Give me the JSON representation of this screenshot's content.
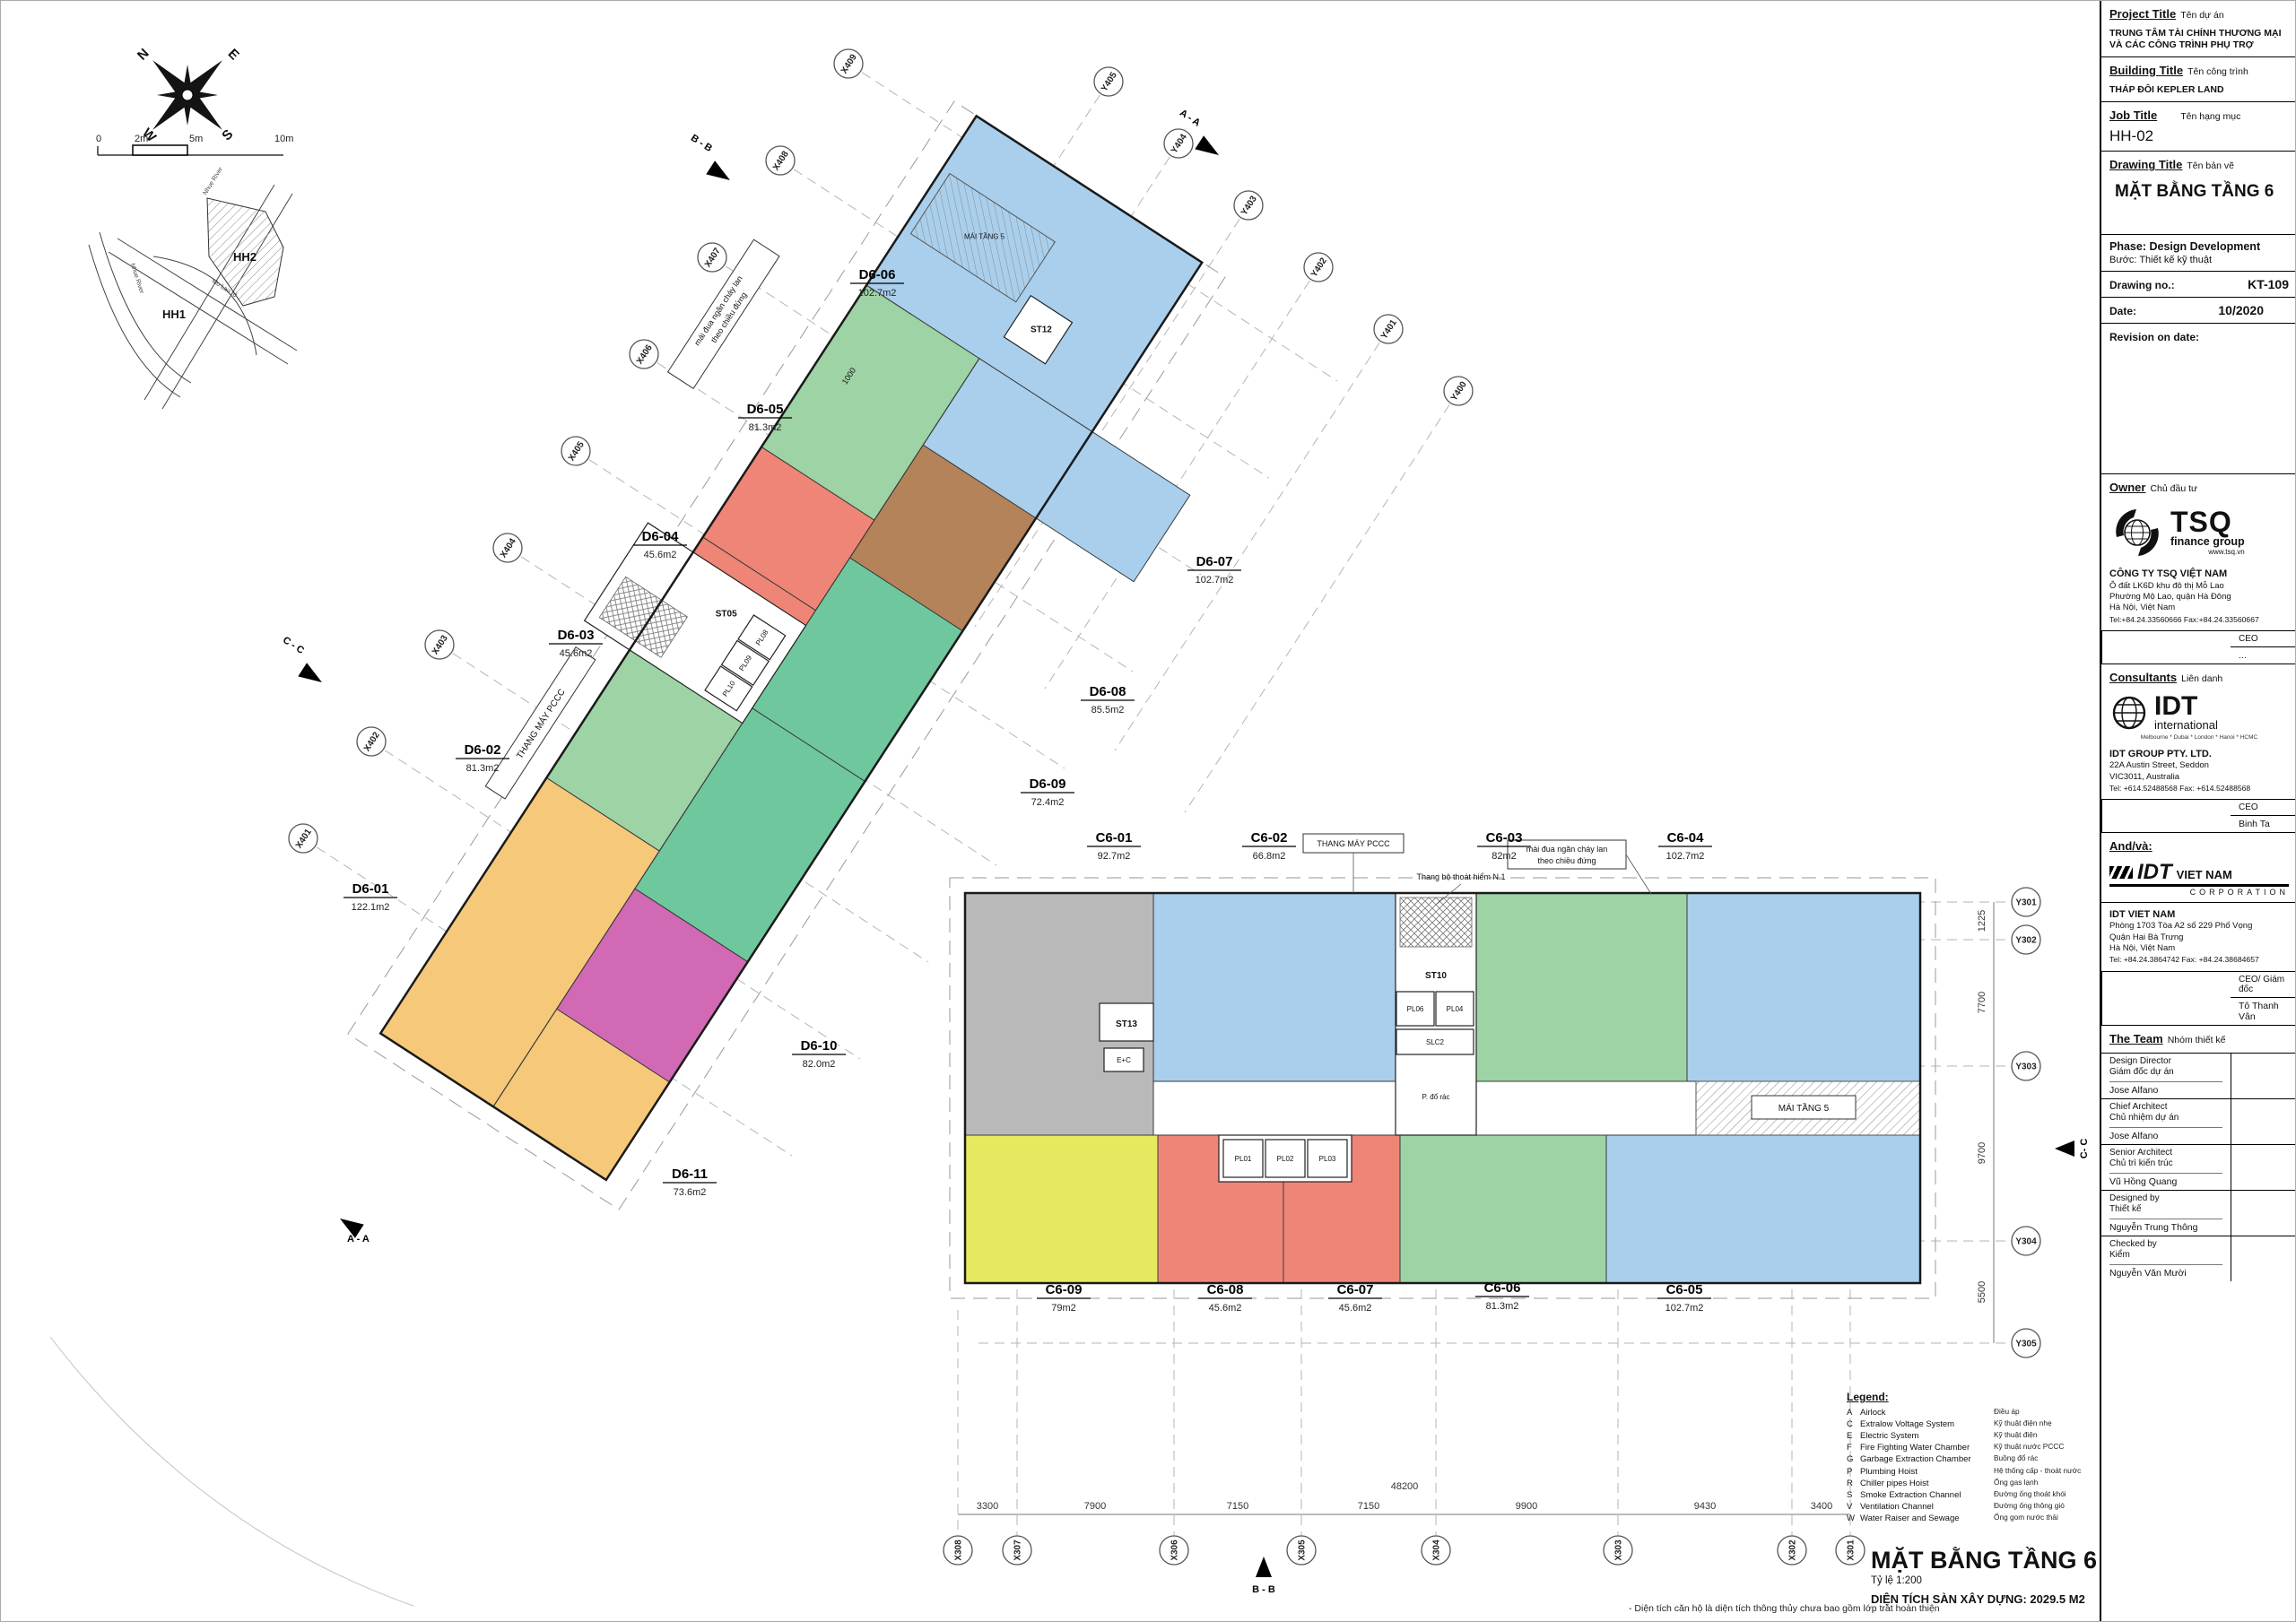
{
  "colors": {
    "blue": "#a9cfec",
    "green": "#9dd3a5",
    "teal": "#6fc79e",
    "red": "#ef8577",
    "orange": "#f6c87a",
    "brown": "#b5835a",
    "magenta": "#d169b5",
    "yellow": "#e6e95f",
    "gray": "#b9b9b9"
  },
  "compass": {
    "n": "N",
    "e": "E",
    "s": "S",
    "w": "W"
  },
  "scale_bar": {
    "t0": "0",
    "t1": "2m",
    "t2": "5m",
    "t3": "10m"
  },
  "location_map": {
    "hh1": "HH1",
    "hh2": "HH2",
    "river": "Nhue River",
    "road": "Mo Lao rd"
  },
  "units": [
    {
      "id": "D6-01",
      "area": "122.1m2",
      "color": "orange"
    },
    {
      "id": "D6-02",
      "area": "81.3m2",
      "color": "green"
    },
    {
      "id": "D6-03",
      "area": "45.6m2",
      "color": "red"
    },
    {
      "id": "D6-04",
      "area": "45.6m2",
      "color": "red"
    },
    {
      "id": "D6-05",
      "area": "81.3m2",
      "color": "green"
    },
    {
      "id": "D6-06",
      "area": "102.7m2",
      "color": "blue"
    },
    {
      "id": "D6-07",
      "area": "102.7m2",
      "color": "blue"
    },
    {
      "id": "D6-08",
      "area": "85.5m2",
      "color": "brown"
    },
    {
      "id": "D6-09",
      "area": "72.4m2",
      "color": "teal"
    },
    {
      "id": "D6-10",
      "area": "82.0m2",
      "color": "teal"
    },
    {
      "id": "D6-11",
      "area": "73.6m2",
      "color": "magenta"
    },
    {
      "id": "C6-01",
      "area": "92.7m2",
      "color": "gray"
    },
    {
      "id": "C6-02",
      "area": "66.8m2",
      "color": "blue"
    },
    {
      "id": "C6-03",
      "area": "82m2",
      "color": "green"
    },
    {
      "id": "C6-04",
      "area": "102.7m2",
      "color": "blue"
    },
    {
      "id": "C6-05",
      "area": "102.7m2",
      "color": "blue"
    },
    {
      "id": "C6-06",
      "area": "81.3m2",
      "color": "green"
    },
    {
      "id": "C6-07",
      "area": "45.6m2",
      "color": "red"
    },
    {
      "id": "C6-08",
      "area": "45.6m2",
      "color": "red"
    },
    {
      "id": "C6-09",
      "area": "79m2",
      "color": "yellow"
    }
  ],
  "grids": {
    "x_diagonal": [
      "X409",
      "X408",
      "X407",
      "X406",
      "X405",
      "X404",
      "X403",
      "X402",
      "X401"
    ],
    "y_diagonal": [
      "Y405",
      "Y404",
      "Y403",
      "Y402",
      "Y401",
      "Y400"
    ],
    "x_bottom": [
      "X308",
      "X307",
      "X306",
      "X305",
      "X304",
      "X303",
      "X302",
      "X301"
    ],
    "y_right": [
      "Y301",
      "Y302",
      "Y303",
      "Y304",
      "Y305"
    ]
  },
  "dims": {
    "bottom": [
      "3300",
      "7900",
      "7150",
      "7150",
      "9900",
      "9430",
      "3400"
    ],
    "bottom_total": "48200",
    "right": [
      "1225",
      "7700",
      "9700",
      "5500"
    ],
    "eave_offset": "1000"
  },
  "sections": {
    "top_b": "B - B",
    "top_a": "A - A",
    "left_c": "C - C",
    "bottom_left_a": "A - A",
    "bottom_b": "B - B",
    "right_c": "C- C"
  },
  "cores": {
    "st05": "ST05",
    "st10": "ST10",
    "st12": "ST12",
    "st13": "ST13",
    "pl01": "PL01",
    "pl02": "PL02",
    "pl03": "PL03",
    "pl04": "PL04",
    "pl06": "PL06",
    "pl08": "PL08",
    "pl09": "PL09",
    "pl10": "PL10",
    "slc2": "SLC2",
    "ec": "E+C",
    "garbage": "P. đổ rác"
  },
  "notes": {
    "fire_lift": "THANG MÁY PCCC",
    "roof": "MÁI TẦNG 5",
    "escape": "Thang bộ thoát hiểm N.1",
    "eave1": "mái đua ngăn cháy lan",
    "eave2": "theo chiều đứng"
  },
  "legend": {
    "title": "Legend:",
    "rows": [
      {
        "key": "A",
        "en": "Airlock",
        "vn": "Điều áp"
      },
      {
        "key": "C",
        "en": "Extralow Voltage System",
        "vn": "Kỹ thuật điện nhẹ"
      },
      {
        "key": "E",
        "en": "Electric System",
        "vn": "Kỹ thuật điện"
      },
      {
        "key": "F",
        "en": "Fire Fighting Water Chamber",
        "vn": "Kỹ thuật nước PCCC"
      },
      {
        "key": "G",
        "en": "Garbage Extraction Chamber",
        "vn": "Buồng đổ rác"
      },
      {
        "key": "P",
        "en": "Plumbing Hoist",
        "vn": "Hệ thống cấp - thoát nước"
      },
      {
        "key": "R",
        "en": "Chiller pipes Hoist",
        "vn": "Ống gas lạnh"
      },
      {
        "key": "S",
        "en": "Smoke Extraction Channel",
        "vn": "Đường ống thoát khói"
      },
      {
        "key": "V",
        "en": "Ventilation Channel",
        "vn": "Đường ống thông gió"
      },
      {
        "key": "W",
        "en": "Water Raiser and Sewage",
        "vn": "Ống gom nước thải"
      }
    ]
  },
  "footer": {
    "title": "MẶT BẰNG TẦNG 6",
    "scale": "Tỷ lệ 1:200",
    "area": "DIỆN TÍCH SÀN XÂY DỰNG: 2029.5 M2",
    "note": "- Diện tích căn hộ là diện tích thông thủy chưa bao gồm lớp trát hoàn thiện"
  },
  "title_block": {
    "project_label": "Project Title",
    "project_label_vn": "Tên dự án",
    "project_line1": "TRUNG TÂM TÀI CHÍNH THƯƠNG MẠI",
    "project_line2": "VÀ CÁC CÔNG TRÌNH PHỤ TRỢ",
    "building_label": "Building Title",
    "building_label_vn": "Tên công trình",
    "building_value": "THÁP ĐÔI KEPLER LAND",
    "job_label": "Job Title",
    "job_label_vn": "Tên hạng mục",
    "job_value": "HH-02",
    "drawing_label": "Drawing Title",
    "drawing_label_vn": "Tên bản vẽ",
    "drawing_value": "MẶT BẰNG TẦNG 6",
    "phase_label": "Phase: Design Development",
    "phase_label_vn": "Bước: Thiết kế kỹ thuật",
    "drawing_no_label": "Drawing no.:",
    "drawing_no_value": "KT-109",
    "date_label": "Date:",
    "date_value": "10/2020",
    "revision_label": "Revision on date:",
    "owner": {
      "label": "Owner",
      "label_vn": "Chủ đầu tư",
      "logo_text": "TSQ",
      "logo_sub": "finance group",
      "logo_web": "www.tsq.vn",
      "company": "CÔNG TY TSQ VIỆT NAM",
      "addr1": "Ô đất LK6D khu đô thị Mỗ Lao",
      "addr2": "Phường Mộ Lao, quận Hà Đông",
      "addr3": "Hà Nội, Việt Nam",
      "tel": "Tel:+84.24.33560666  Fax:+84.24.33560667",
      "ceo_label": "CEO",
      "ceo_value": "..."
    },
    "consultants": {
      "label": "Consultants",
      "label_vn": "Liên danh",
      "logo_text": "IDT",
      "logo_sub": "international",
      "logo_cities": "Melbourne * Dubai * London * Hanoi * HCMC",
      "company": "IDT GROUP PTY. LTD.",
      "addr1": "22A Austin Street, Seddon",
      "addr2": "VIC3011, Australia",
      "tel": "Tel:  +614.52488568 Fax: +614.52488568",
      "ceo_label": "CEO",
      "ceo_value": "Binh Ta"
    },
    "andva_label": "And/và:",
    "idt_vietnam": {
      "logo_text": "IDT",
      "logo_vn": "VIET NAM",
      "logo_corp": "CORPORATION",
      "company": "IDT VIET NAM",
      "addr1": "Phòng 1703 Tòa A2 số 229 Phố Vọng",
      "addr2": "Quận Hai Bà Trưng",
      "addr3": "Hà Nội, Việt Nam",
      "tel": "Tel:  +84.24.3864742 Fax: +84.24.38684657",
      "ceo_label": "CEO/ Giám đốc",
      "ceo_value": "Tô Thanh Vân"
    },
    "team": {
      "label": "The Team",
      "label_vn": "Nhóm thiết kế",
      "rows": [
        {
          "role_en": "Design Director",
          "role_vn": "Giám đốc dự án",
          "name": "Jose Alfano"
        },
        {
          "role_en": "Chief Architect",
          "role_vn": "Chủ nhiệm dự án",
          "name": "Jose Alfano"
        },
        {
          "role_en": "Senior Architect",
          "role_vn": "Chủ trì kiến trúc",
          "name": "Vũ Hồng Quang"
        },
        {
          "role_en": "Designed by",
          "role_vn": "Thiết kế",
          "name": "Nguyễn Trung Thông"
        },
        {
          "role_en": "Checked by",
          "role_vn": "Kiểm",
          "name": "Nguyễn Văn Mười"
        }
      ]
    }
  }
}
